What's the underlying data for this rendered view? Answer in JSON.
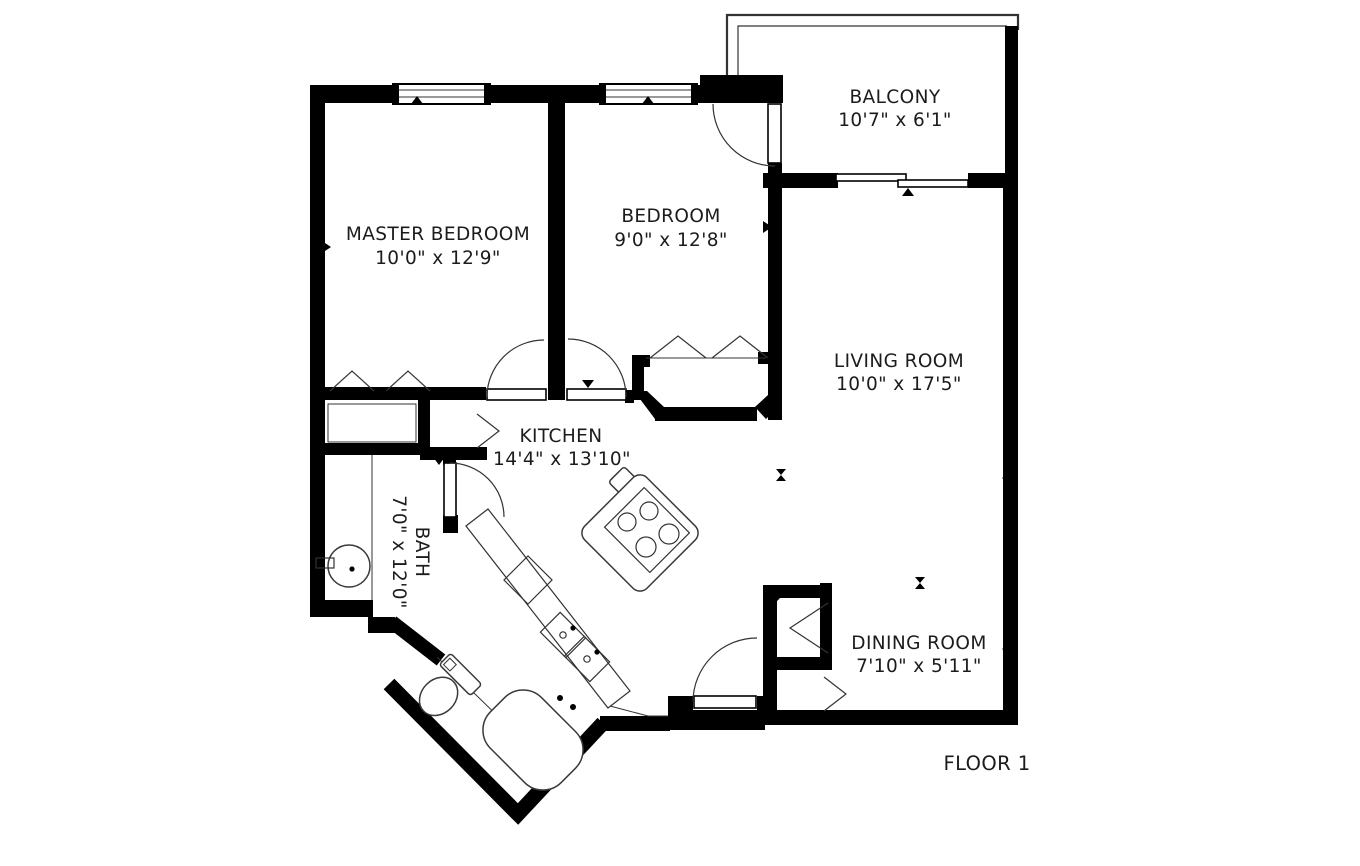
{
  "plan": {
    "floor_label": "FLOOR 1",
    "rooms": {
      "master": {
        "name": "MASTER BEDROOM",
        "dims": "10'0\" x 12'9\""
      },
      "bedroom": {
        "name": "BEDROOM",
        "dims": "9'0\" x 12'8\""
      },
      "balcony": {
        "name": "BALCONY",
        "dims": "10'7\" x 6'1\""
      },
      "living": {
        "name": "LIVING ROOM",
        "dims": "10'0\" x 17'5\""
      },
      "kitchen": {
        "name": "KITCHEN",
        "dims": "14'4\" x 13'10\""
      },
      "bath": {
        "name": "BATH",
        "dims": "7'0\" x 12'0\""
      },
      "dining": {
        "name": "DINING ROOM",
        "dims": "7'10\" x 5'11\""
      }
    },
    "colors": {
      "wall": "#000000",
      "line": "#333333",
      "text": "#1c1c1c",
      "background": "#ffffff"
    }
  }
}
